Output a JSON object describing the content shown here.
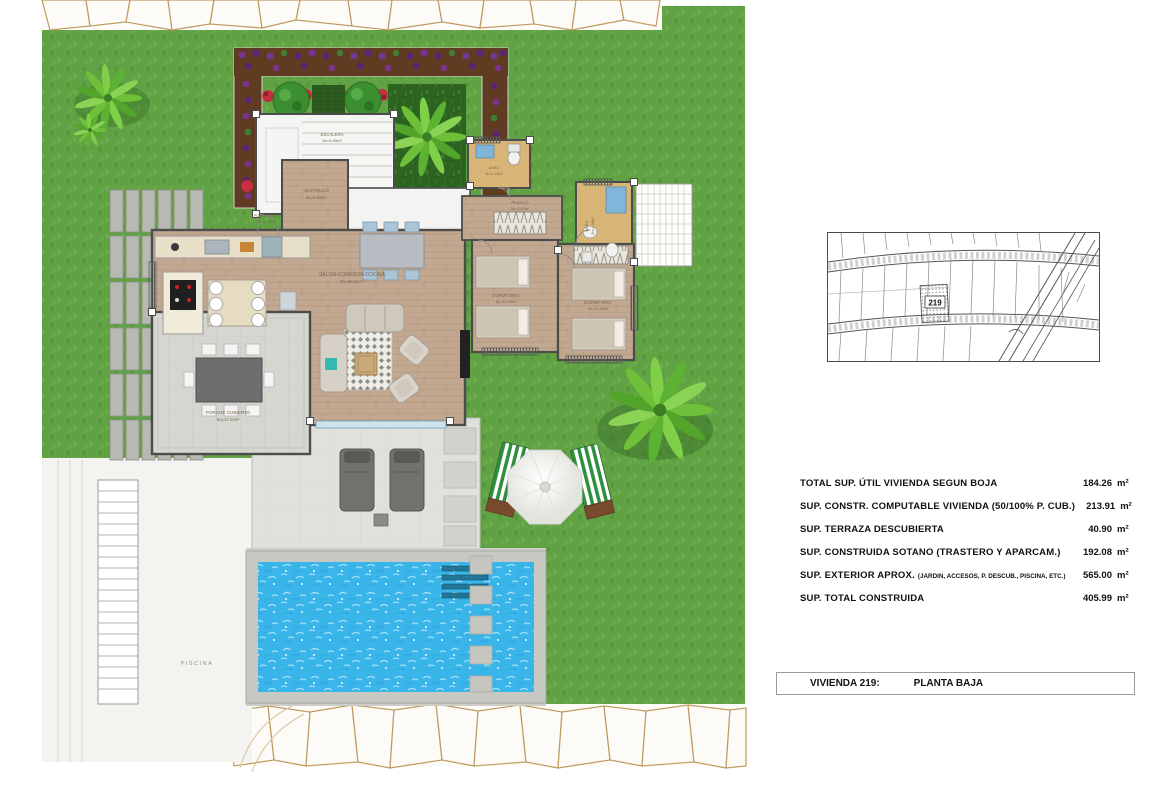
{
  "colors": {
    "grass": "#61a245",
    "pool_water": "#3ab5e9",
    "wood_floor": "#c2a891",
    "tile_floor": "#d9b678",
    "terrace": "#e1e1db",
    "porch": "#d6d6d1",
    "soil_bed": "#5f3b22",
    "flower_red": "#c62f3f",
    "flower_purple": "#7a3390",
    "palm_leaf": "#6fbf39",
    "stone_outline": "#bf9a5f",
    "wall": "#4c4c4c"
  },
  "plan": {
    "labels": {
      "escalera": {
        "name": "ESCALERA",
        "area": "Su=4.90m²"
      },
      "vestibulo": {
        "name": "VESTIBULO",
        "area": "Su=5.30m²"
      },
      "porche_cub": {
        "name": "PORCHE CUB.",
        "area": "Su=1.97m²"
      },
      "salon": {
        "name": "SALON-COMEDOR-COCINA",
        "area": "Su=66.51m²"
      },
      "aseo": {
        "name": "ASEO",
        "area": "Su=2.25m²"
      },
      "pasillo": {
        "name": "PASILLO",
        "area": "Su=2.92m²"
      },
      "bano": {
        "name": "BAÑO",
        "area": "Su=4.08m²"
      },
      "dormitorio_1": {
        "name": "DORMITORIO",
        "area": "Su=12.20m²"
      },
      "dormitorio_2": {
        "name": "DORMITORIO",
        "area": "Su=12.20m²"
      },
      "porche_cubierto": {
        "name": "PORCHE CUBIERTO",
        "area": "Su=17.12m²"
      },
      "piscina": {
        "name": "PISCINA"
      }
    }
  },
  "sitemap": {
    "plot_number": "219"
  },
  "areas_table": {
    "rows": [
      {
        "label": "TOTAL SUP. ÚTIL VIVIENDA SEGUN BOJA",
        "value": "184.26",
        "unit": "m²"
      },
      {
        "label": "SUP. CONSTR. COMPUTABLE VIVIENDA (50/100% P. CUB.)",
        "value": "213.91",
        "unit": "m²"
      },
      {
        "label": "SUP. TERRAZA DESCUBIERTA",
        "value": "40.90",
        "unit": "m²"
      },
      {
        "label": "SUP. CONSTRUIDA SOTANO (TRASTERO Y APARCAM.)",
        "value": "192.08",
        "unit": "m²"
      },
      {
        "label": "SUP. EXTERIOR APROX.",
        "sublabel": "(JARDIN, ACCESOS, P. DESCUB., PISCINA, ETC.)",
        "value": "565.00",
        "unit": "m²"
      },
      {
        "label": "SUP. TOTAL CONSTRUIDA",
        "value": "405.99",
        "unit": "m²"
      }
    ]
  },
  "title_bar": {
    "unit_label": "VIVIENDA 219:",
    "floor_label": "PLANTA BAJA"
  }
}
